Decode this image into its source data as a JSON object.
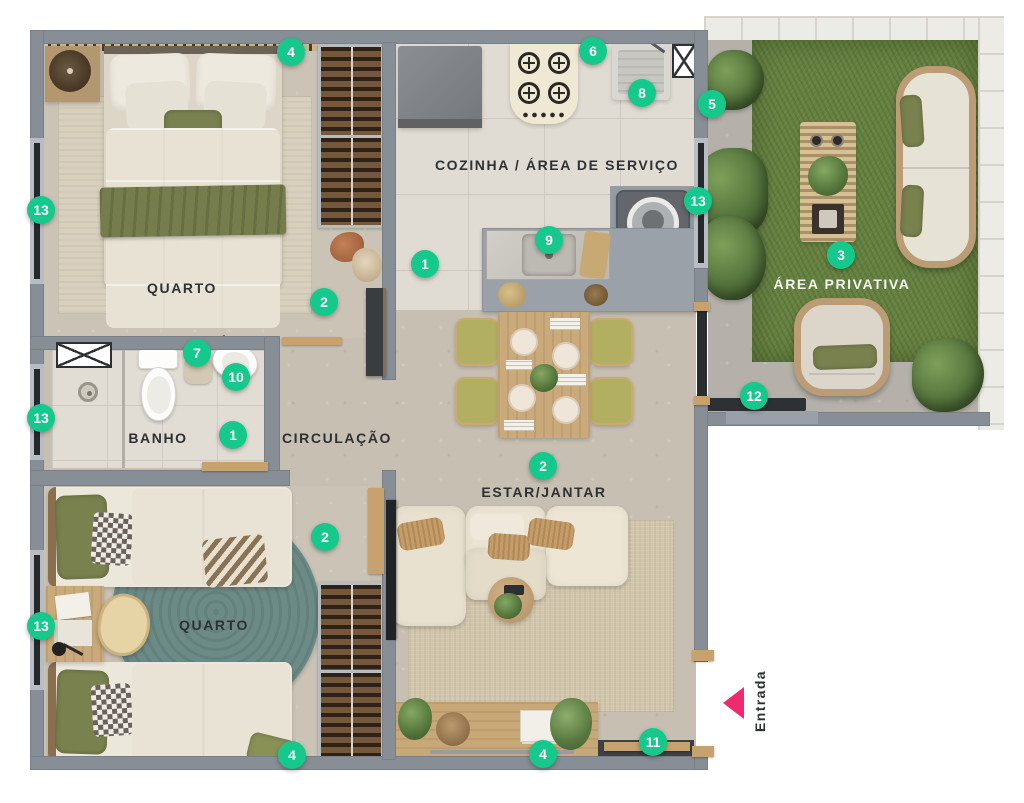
{
  "plan": {
    "title": "Planta do apartamento",
    "rooms": {
      "quarto1": "QUARTO",
      "cozinha": "COZINHA / ÁREA DE SERVIÇO",
      "area_privativa": "ÁREA PRIVATIVA",
      "banho": "BANHO",
      "circulacao": "CIRCULAÇÃO",
      "estar_jantar": "ESTAR/JANTAR",
      "quarto2": "QUARTO"
    },
    "entrance_label": "Entrada",
    "colors": {
      "marker_green": "#15c98c",
      "entry_pink": "#f02a6e",
      "wall_gray": "#878e96",
      "grass_green": "#668240"
    },
    "markers": [
      {
        "n": "4",
        "x": 291,
        "y": 52
      },
      {
        "n": "6",
        "x": 593,
        "y": 51
      },
      {
        "n": "8",
        "x": 642,
        "y": 93
      },
      {
        "n": "5",
        "x": 712,
        "y": 104
      },
      {
        "n": "13",
        "x": 41,
        "y": 210
      },
      {
        "n": "13",
        "x": 698,
        "y": 201
      },
      {
        "n": "9",
        "x": 549,
        "y": 240
      },
      {
        "n": "3",
        "x": 841,
        "y": 255
      },
      {
        "n": "1",
        "x": 425,
        "y": 264
      },
      {
        "n": "2",
        "x": 324,
        "y": 302
      },
      {
        "n": "7",
        "x": 197,
        "y": 353
      },
      {
        "n": "10",
        "x": 236,
        "y": 377
      },
      {
        "n": "12",
        "x": 754,
        "y": 396
      },
      {
        "n": "13",
        "x": 41,
        "y": 418
      },
      {
        "n": "1",
        "x": 233,
        "y": 435
      },
      {
        "n": "2",
        "x": 543,
        "y": 466
      },
      {
        "n": "2",
        "x": 325,
        "y": 537
      },
      {
        "n": "13",
        "x": 41,
        "y": 626
      },
      {
        "n": "11",
        "x": 653,
        "y": 742
      },
      {
        "n": "4",
        "x": 292,
        "y": 755
      },
      {
        "n": "4",
        "x": 543,
        "y": 754
      }
    ]
  }
}
